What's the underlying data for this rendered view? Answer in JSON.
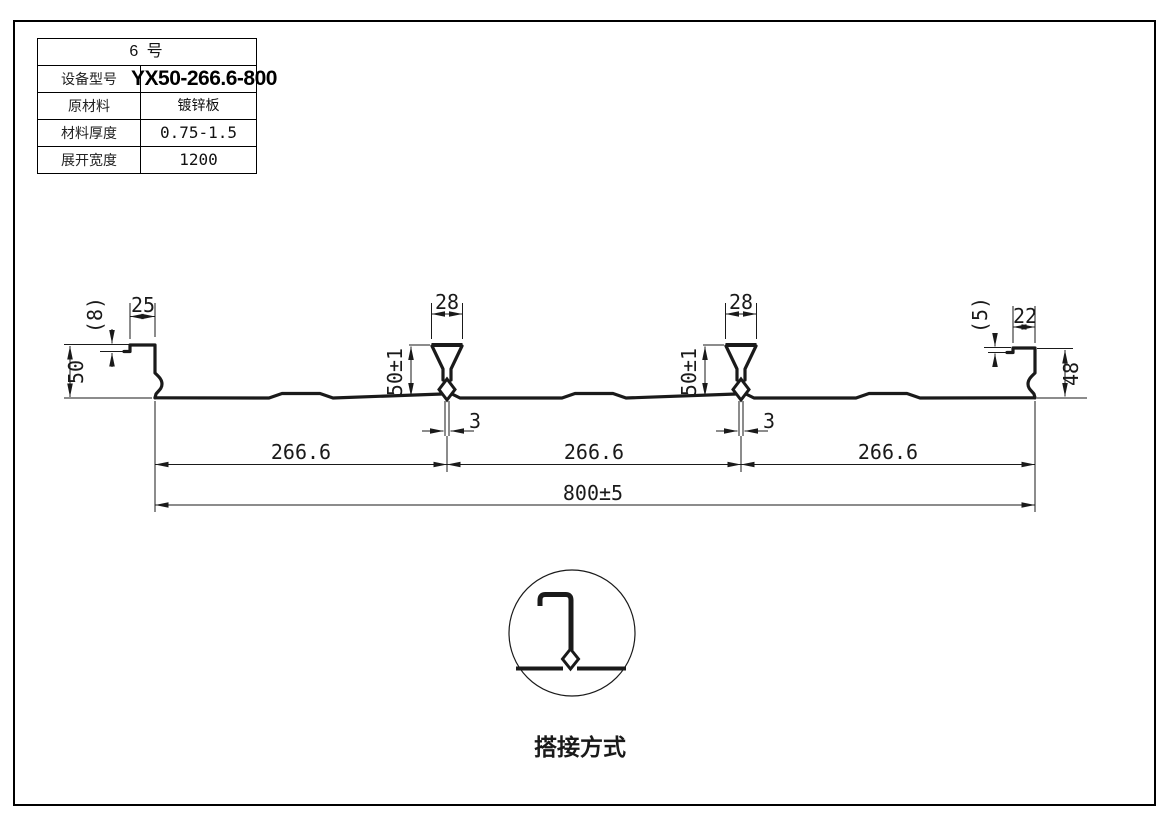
{
  "spec_table": {
    "title": "6  号",
    "rows": [
      {
        "label": "设备型号",
        "value": "YX50-266.6-800"
      },
      {
        "label": "原材料",
        "value": "镀锌板"
      },
      {
        "label": "材料厚度",
        "value": "0.75-1.5"
      },
      {
        "label": "展开宽度",
        "value": "1200"
      }
    ]
  },
  "profile": {
    "dims": {
      "left_edge_step": "(8)",
      "left_lip": "25",
      "left_height": "50",
      "rib_width": "28",
      "rib_height": "50±1",
      "rib_bottom_gap": "3",
      "pitch": "266.6",
      "overall_width": "800±5",
      "right_lip": "22",
      "right_edge_step": "(5)",
      "right_height": "48"
    }
  },
  "detail": {
    "caption": "搭接方式"
  },
  "colors": {
    "line": "#1a1a1a",
    "background": "#ffffff",
    "frame": "#000000"
  }
}
